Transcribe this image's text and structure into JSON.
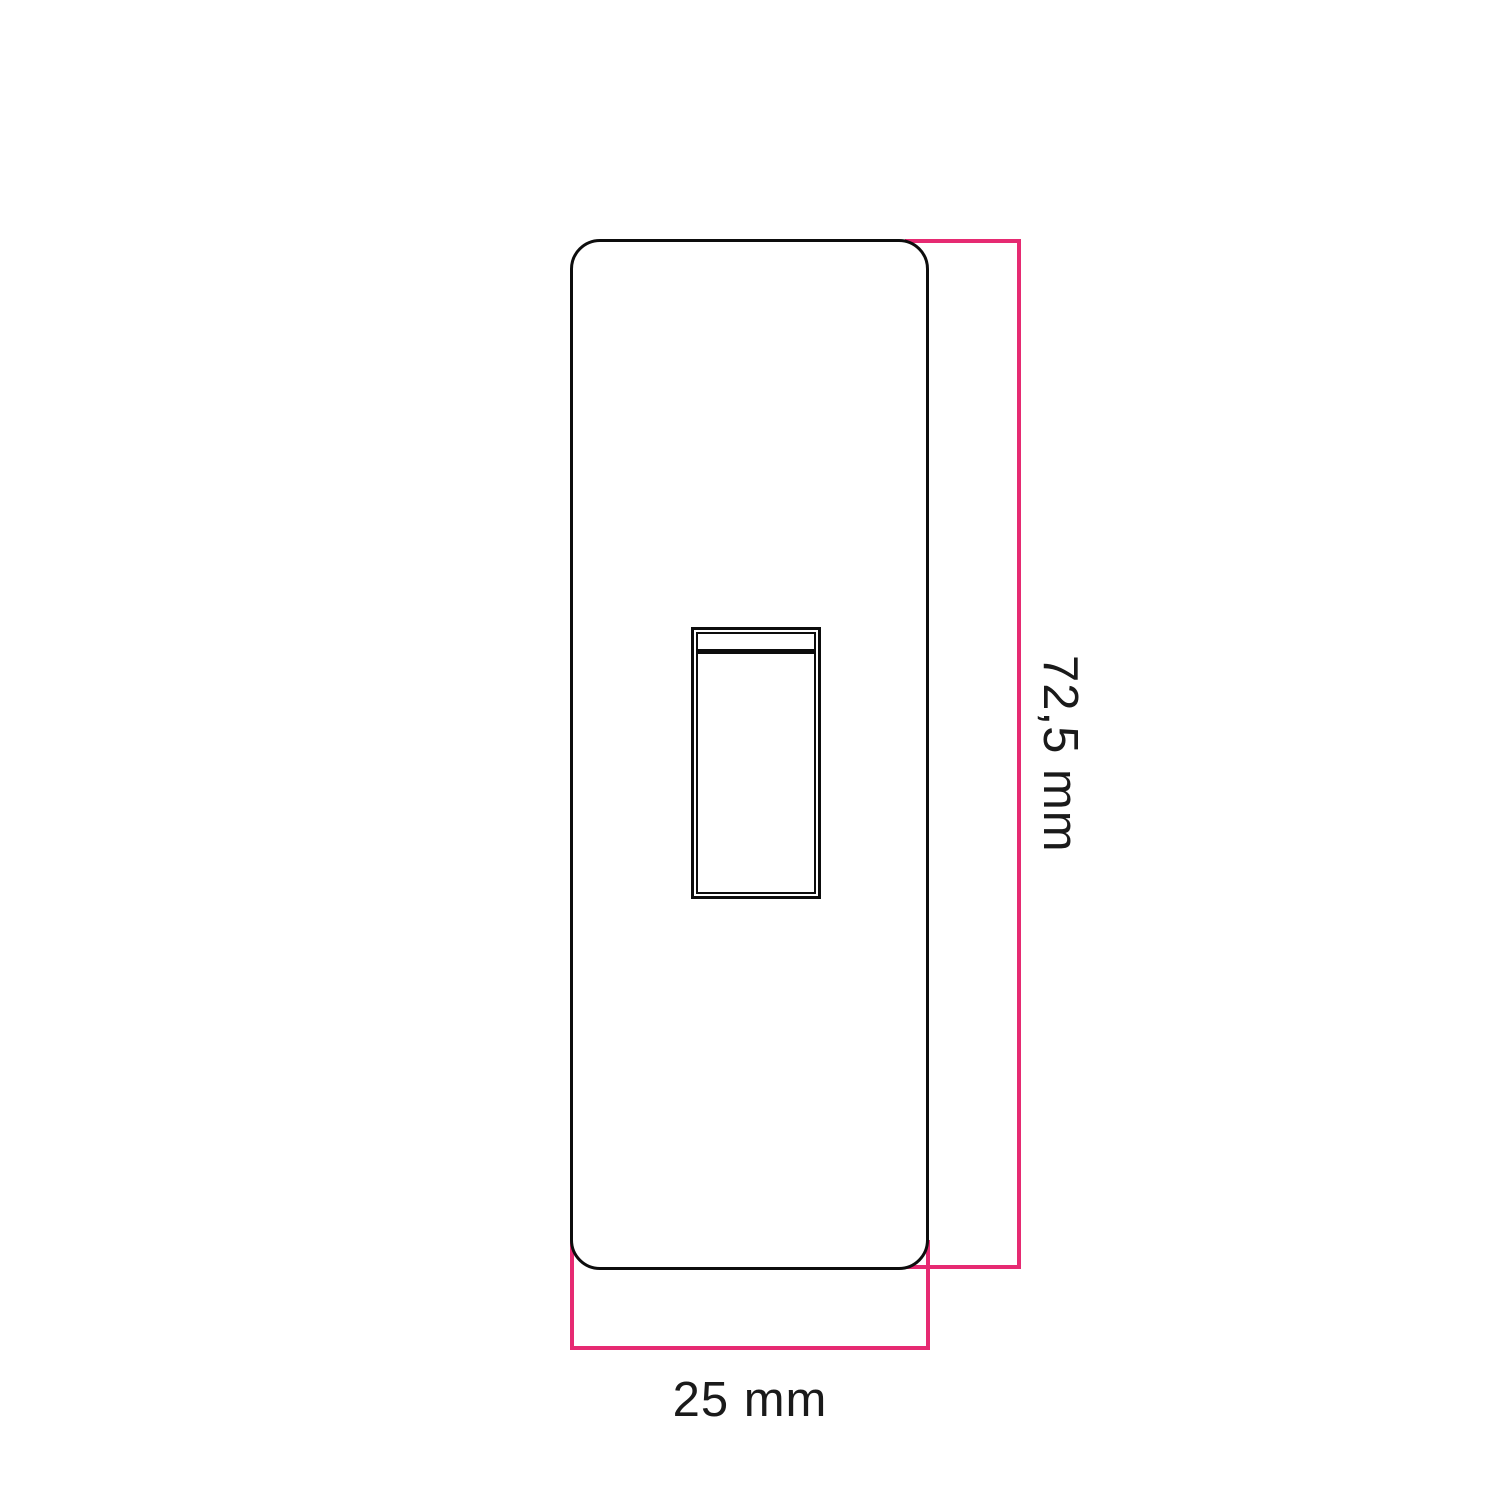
{
  "drawing": {
    "type": "technical-dimension-diagram",
    "subject": "rocker-switch-front-plate",
    "height_dimension": {
      "label": "72,5 mm"
    },
    "width_dimension": {
      "label": "25 mm"
    }
  },
  "colors": {
    "accent": "#e62a72",
    "line": "#0d0d0d",
    "text": "#1a1a1a",
    "bg": "#ffffff"
  }
}
